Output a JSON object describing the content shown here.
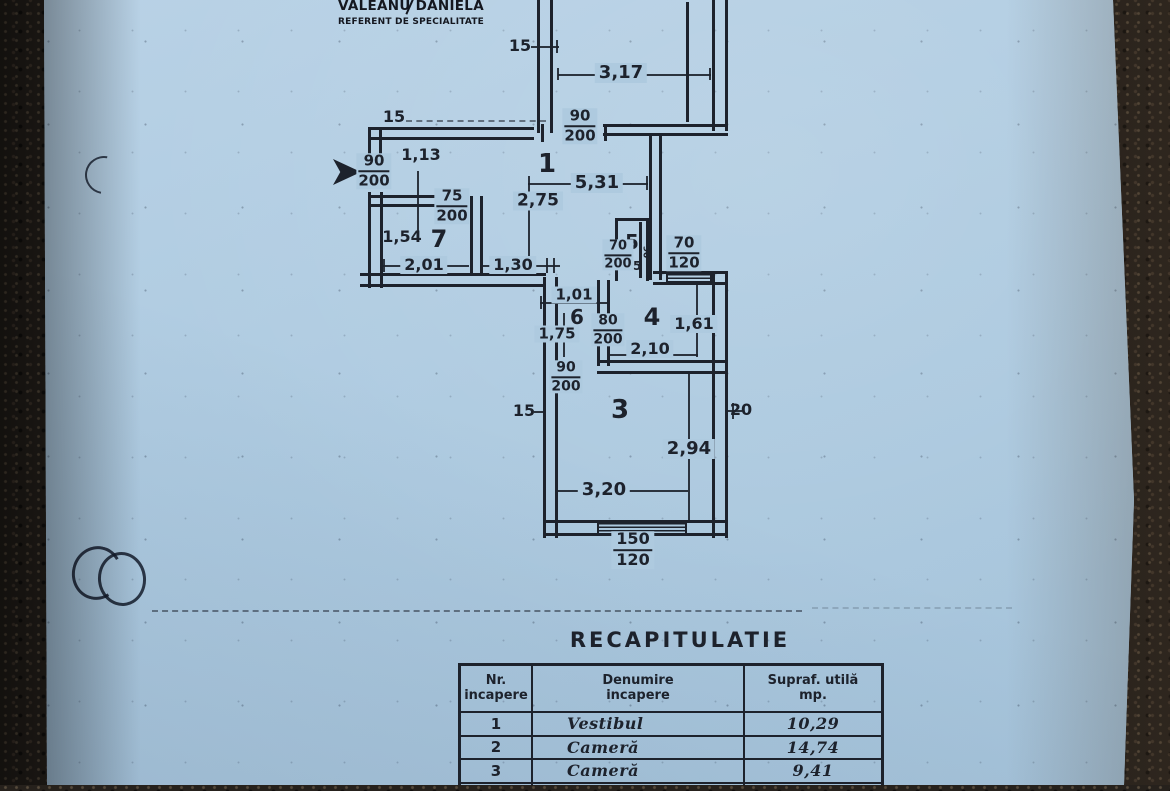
{
  "document": {
    "author": {
      "name": "VALEANU DANIELA",
      "title": "REFERENT DE SPECIALITATE"
    }
  },
  "plan": {
    "rooms": [
      {
        "name": "room-number-1",
        "t": "1",
        "x": 547,
        "y": 164,
        "fs": 26
      },
      {
        "name": "room-number-7",
        "t": "7",
        "x": 439,
        "y": 239,
        "fs": 24
      },
      {
        "name": "room-number-5",
        "t": "5",
        "x": 632,
        "y": 242,
        "fs": 20
      },
      {
        "name": "room-number-6",
        "t": "6",
        "x": 577,
        "y": 317,
        "fs": 20
      },
      {
        "name": "room-number-4",
        "t": "4",
        "x": 652,
        "y": 317,
        "fs": 24
      },
      {
        "name": "room-number-3",
        "t": "3",
        "x": 620,
        "y": 410,
        "fs": 26
      }
    ],
    "dims": [
      {
        "t": "15",
        "x": 520,
        "y": 46,
        "fs": 16
      },
      {
        "t": "3,17",
        "x": 621,
        "y": 73,
        "fs": 18,
        "bg": 1
      },
      {
        "t": "15",
        "x": 394,
        "y": 117,
        "fs": 16
      },
      {
        "t": "1,13",
        "x": 421,
        "y": 155,
        "fs": 16
      },
      {
        "t": "5,31",
        "x": 597,
        "y": 183,
        "fs": 18,
        "bg": 1
      },
      {
        "t": "2,75",
        "x": 538,
        "y": 201,
        "fs": 17,
        "bg": 1
      },
      {
        "t": "1,54",
        "x": 402,
        "y": 237,
        "fs": 16
      },
      {
        "t": "2,01",
        "x": 424,
        "y": 265,
        "fs": 16,
        "bg": 1
      },
      {
        "t": "1,30",
        "x": 513,
        "y": 265,
        "fs": 16,
        "bg": 1
      },
      {
        "t": "45",
        "x": 633,
        "y": 266,
        "fs": 12
      },
      {
        "t": "90",
        "x": 645,
        "y": 252,
        "fs": 9,
        "rot": 90
      },
      {
        "t": "1,01",
        "x": 574,
        "y": 295,
        "fs": 15,
        "bg": 1
      },
      {
        "t": "1,75",
        "x": 557,
        "y": 334,
        "fs": 15,
        "bg": 1
      },
      {
        "t": "1,61",
        "x": 694,
        "y": 324,
        "fs": 16,
        "bg": 1
      },
      {
        "t": "2,10",
        "x": 650,
        "y": 349,
        "fs": 16,
        "bg": 1
      },
      {
        "t": "15",
        "x": 524,
        "y": 411,
        "fs": 16
      },
      {
        "t": "20",
        "x": 741,
        "y": 410,
        "fs": 16
      },
      {
        "t": "2,94",
        "x": 689,
        "y": 449,
        "fs": 18,
        "bg": 1
      },
      {
        "t": "3,20",
        "x": 604,
        "y": 490,
        "fs": 18,
        "bg": 1
      }
    ],
    "door_window_sizes": [
      {
        "name": "door-90-200-room2",
        "top": "90",
        "bot": "200",
        "x": 580,
        "y": 126,
        "fs": 15
      },
      {
        "name": "door-90-200-entrance",
        "top": "90",
        "bot": "200",
        "x": 374,
        "y": 171,
        "fs": 15
      },
      {
        "name": "door-75-200-room7",
        "top": "75",
        "bot": "200",
        "x": 452,
        "y": 206,
        "fs": 15
      },
      {
        "name": "door-70-200-room5",
        "top": "70",
        "bot": "200",
        "x": 618,
        "y": 255,
        "fs": 13
      },
      {
        "name": "window-70-120",
        "top": "70",
        "bot": "120",
        "x": 684,
        "y": 253,
        "fs": 15
      },
      {
        "name": "door-80-200-room4",
        "top": "80",
        "bot": "200",
        "x": 608,
        "y": 330,
        "fs": 14
      },
      {
        "name": "door-90-200-room3",
        "top": "90",
        "bot": "200",
        "x": 566,
        "y": 377,
        "fs": 14
      },
      {
        "name": "window-150-120",
        "top": "150",
        "bot": "120",
        "x": 633,
        "y": 550,
        "fs": 16
      }
    ]
  },
  "recap": {
    "title": "RECAPITULATIE",
    "columns": [
      {
        "line1": "Nr.",
        "line2": "incapere"
      },
      {
        "line1": "Denumire",
        "line2": "incapere"
      },
      {
        "line1": "Supraf. utilă",
        "line2": "mp."
      }
    ],
    "rows": [
      {
        "nr": "1",
        "denumire": "Vestibul",
        "suprafata": "10,29"
      },
      {
        "nr": "2",
        "denumire": "Cameră",
        "suprafata": "14,74"
      },
      {
        "nr": "3",
        "denumire": "Cameră",
        "suprafata": "9,41"
      }
    ]
  },
  "colors": {
    "paper": "#b2cce1",
    "ink": "#1d222c",
    "background_stone": "#26211c"
  }
}
